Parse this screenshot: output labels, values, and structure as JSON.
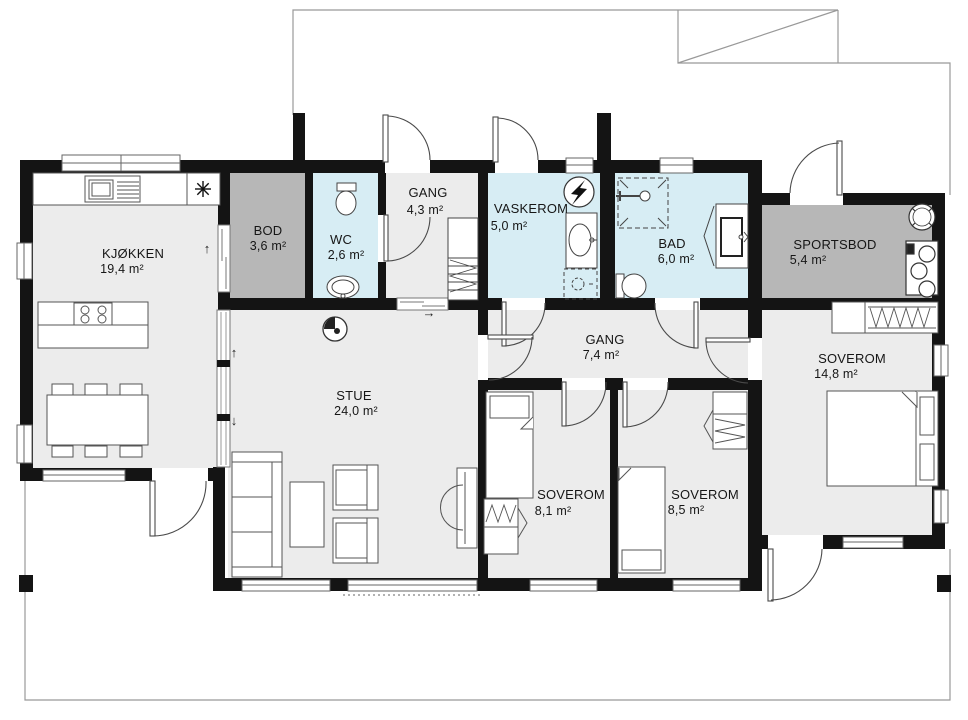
{
  "plan_type": "floor-plan",
  "rooms": [
    {
      "id": "kjokken",
      "name": "KJØKKEN",
      "area": "19,4 m²"
    },
    {
      "id": "bod",
      "name": "BOD",
      "area": "3,6 m²"
    },
    {
      "id": "wc",
      "name": "WC",
      "area": "2,6 m²"
    },
    {
      "id": "gang-entry",
      "name": "GANG",
      "area": "4,3 m²"
    },
    {
      "id": "vaskerom",
      "name": "VASKEROM",
      "area": "5,0 m²"
    },
    {
      "id": "bad",
      "name": "BAD",
      "area": "6,0 m²"
    },
    {
      "id": "sportsbod",
      "name": "SPORTSBOD",
      "area": "5,4 m²"
    },
    {
      "id": "gang-hall",
      "name": "GANG",
      "area": "7,4 m²"
    },
    {
      "id": "stue",
      "name": "STUE",
      "area": "24,0 m²"
    },
    {
      "id": "soverom-1",
      "name": "SOVEROM",
      "area": "8,1 m²"
    },
    {
      "id": "soverom-2",
      "name": "SOVEROM",
      "area": "8,5 m²"
    },
    {
      "id": "soverom-3",
      "name": "SOVEROM",
      "area": "14,8 m²"
    }
  ],
  "annotations": {
    "arrow_up": "↑",
    "arrow_down": "↓",
    "arrow_right": "→"
  },
  "icons": {
    "fridge": "asterisk-snowflake",
    "electrical_panel": "lightning-bolt-in-circle",
    "shower": "shower-head",
    "fireplace": "round-stove",
    "stairs": "stair-with-break-line"
  },
  "colors": {
    "wall": "#141414",
    "floor": "#ececec",
    "storage_floor": "#b7b7b7",
    "wet_room_floor": "#d7edf4",
    "outline": "#999999",
    "fixture_line": "#4a4a4a"
  }
}
